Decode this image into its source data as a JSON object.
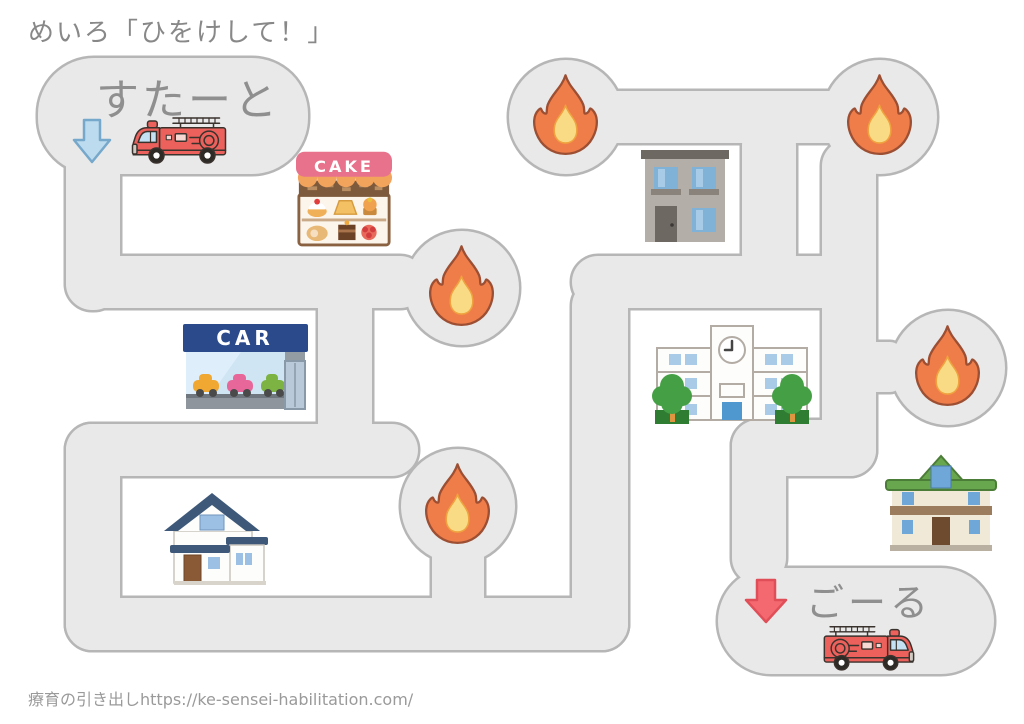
{
  "page": {
    "title": "めいろ「ひをけして！」",
    "footer_credit": "療育の引き出しhttps://ke-sensei-habilitation.com/"
  },
  "maze": {
    "start_label": "すたーと",
    "goal_label": "ごーる",
    "signs": {
      "cake_shop": "CAKE",
      "car_dealer": "CAR"
    },
    "fire_icon_count": 5,
    "landmarks": [
      "cake-shop",
      "car-dealer",
      "apartment-building",
      "school",
      "blue-roof-house",
      "green-roof-house"
    ],
    "colors": {
      "path_fill": "#e9e9e9",
      "path_stroke": "#b6b6b6",
      "flame_outer": "#ef7d49",
      "flame_inner": "#f9da85",
      "fire_truck_red": "#ec615c",
      "start_arrow_blue": "#bcdbee",
      "goal_arrow_red": "#f4696f",
      "label_gray": "#8f8f8f"
    }
  }
}
